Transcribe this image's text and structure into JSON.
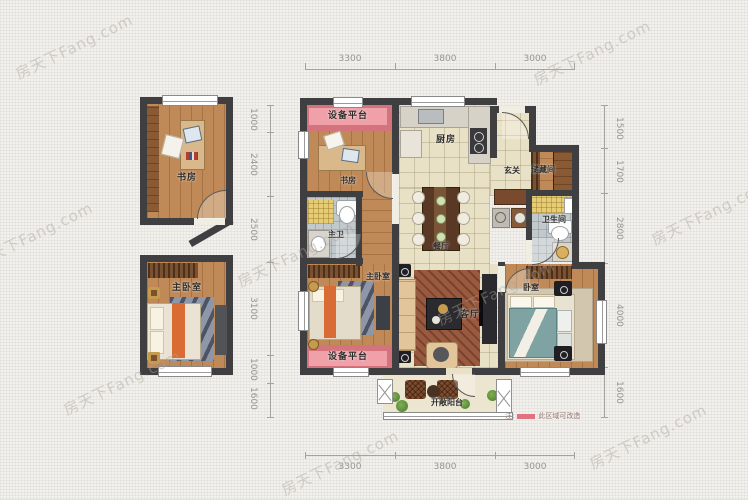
{
  "watermark": {
    "text": "房天下Fang.com"
  },
  "dimensions": {
    "top": [
      "3300",
      "3800",
      "3000"
    ],
    "bottom": [
      "3300",
      "3800",
      "3000"
    ],
    "left": [
      "1000",
      "2400",
      "2500",
      "3100",
      "1000",
      "1600"
    ],
    "right": [
      "1500",
      "1700",
      "2800",
      "4000",
      "1600"
    ]
  },
  "rooms": {
    "study_left": "书房",
    "master_bedroom_left": "主卧室",
    "equipment_platform_top": "设备平台",
    "study_center": "书房",
    "master_bathroom": "主卫",
    "kitchen": "厨房",
    "entry": "玄关",
    "storage": "储藏间",
    "bathroom": "卫生间",
    "dining": "餐厅",
    "master_bedroom_center": "主卧室",
    "bedroom_right": "卧室",
    "living": "客厅",
    "equipment_platform_bottom": "设备平台",
    "balcony": "开敞阳台"
  },
  "legend": {
    "label": "注:",
    "note": "此区域可改造",
    "swatch_color": "#e0737e"
  },
  "colors": {
    "wall": "#3f3f41",
    "wood_floor": "#c08a58",
    "tile_floor": "#e9e1c6",
    "bath_tile": "#c2c9cd",
    "equipment_platform": "#efa0a8",
    "equipment_platform_border": "#d4737c",
    "balcony_floor": "#ece5d0"
  }
}
